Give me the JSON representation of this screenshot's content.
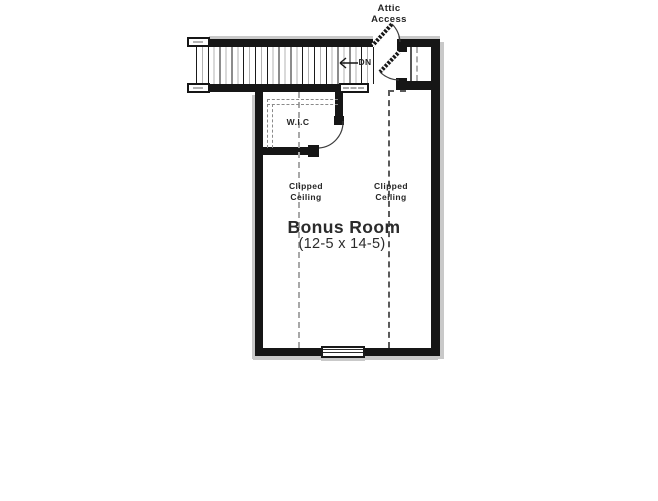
{
  "plan": {
    "attic_access": {
      "line1": "Attic",
      "line2": "Access"
    },
    "stairs": {
      "down_label": "DN"
    },
    "closet": {
      "label": "W.I.C"
    },
    "ceiling_note_left": {
      "line1": "Clipped",
      "line2": "Ceiling"
    },
    "ceiling_note_right": {
      "line1": "Clipped",
      "line2": "Ceiling"
    },
    "room": {
      "name": "Bonus Room",
      "dimensions": "(12-5 x 14-5)"
    }
  },
  "colors": {
    "wall": "#161616",
    "wall_shadow": "#c9c9c9",
    "clipped_ceiling_dash_left": "#a8a8a8",
    "clipped_ceiling_dash_right": "#5a5a5a",
    "tread_alt": "#b3b3b3",
    "background": "#ffffff"
  }
}
